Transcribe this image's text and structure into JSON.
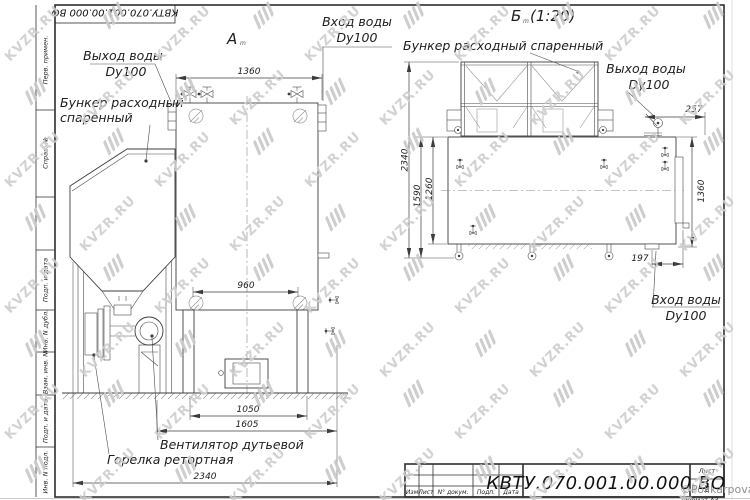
{
  "watermark": {
    "text": "KVZR.RU",
    "copyright": "©PolikarpovaMG2021"
  },
  "frame": {
    "top_designation": "КВТУ.070.001.00.000 ВО",
    "margin_fields": {
      "perv": "Перв. примен.",
      "sprav": "Справ. №",
      "podp1": "Подп. и дата",
      "inv_dubl": "Инв. N дубл.",
      "vzam": "Взам. инв. N",
      "podp2": "Подп. и дата",
      "inv_podl": "Инв. N подл."
    }
  },
  "title_block": {
    "designation": "КВТУ.070.001.00.000 ВО",
    "col_izm": "Изм",
    "col_list": "Лист",
    "col_doc": "N° докум.",
    "col_podp": "Подп.",
    "col_data": "Дата",
    "sheet_label": "Лист",
    "sheet_number": "2",
    "format": "Формат А3"
  },
  "view_a": {
    "label": "А",
    "mark": "m",
    "dim_1360": "1360",
    "dim_960": "960",
    "dim_1050": "1050",
    "dim_1605": "1605",
    "dim_2340": "2340",
    "water_out_1": "Выход воды",
    "water_out_2": "Dy100",
    "hopper_1": "Бункер расходный",
    "hopper_2": "спаренный",
    "water_in_1": "Вход воды",
    "water_in_2": "Dy100",
    "fan": "Вентилятор дутьевой",
    "burner": "Горелка ретортная"
  },
  "view_b": {
    "label": "Б",
    "mark": "m",
    "scale": "(1:20)",
    "dim_2340": "2340",
    "dim_1590": "1590",
    "dim_1260": "1260",
    "dim_1360": "1360",
    "dim_257": "257",
    "dim_197": "197",
    "hopper": "Бункер расходный спаренный",
    "water_out_1": "Выход воды",
    "water_out_2": "Dy100",
    "water_in_1": "Вход воды",
    "water_in_2": "Dy100"
  }
}
